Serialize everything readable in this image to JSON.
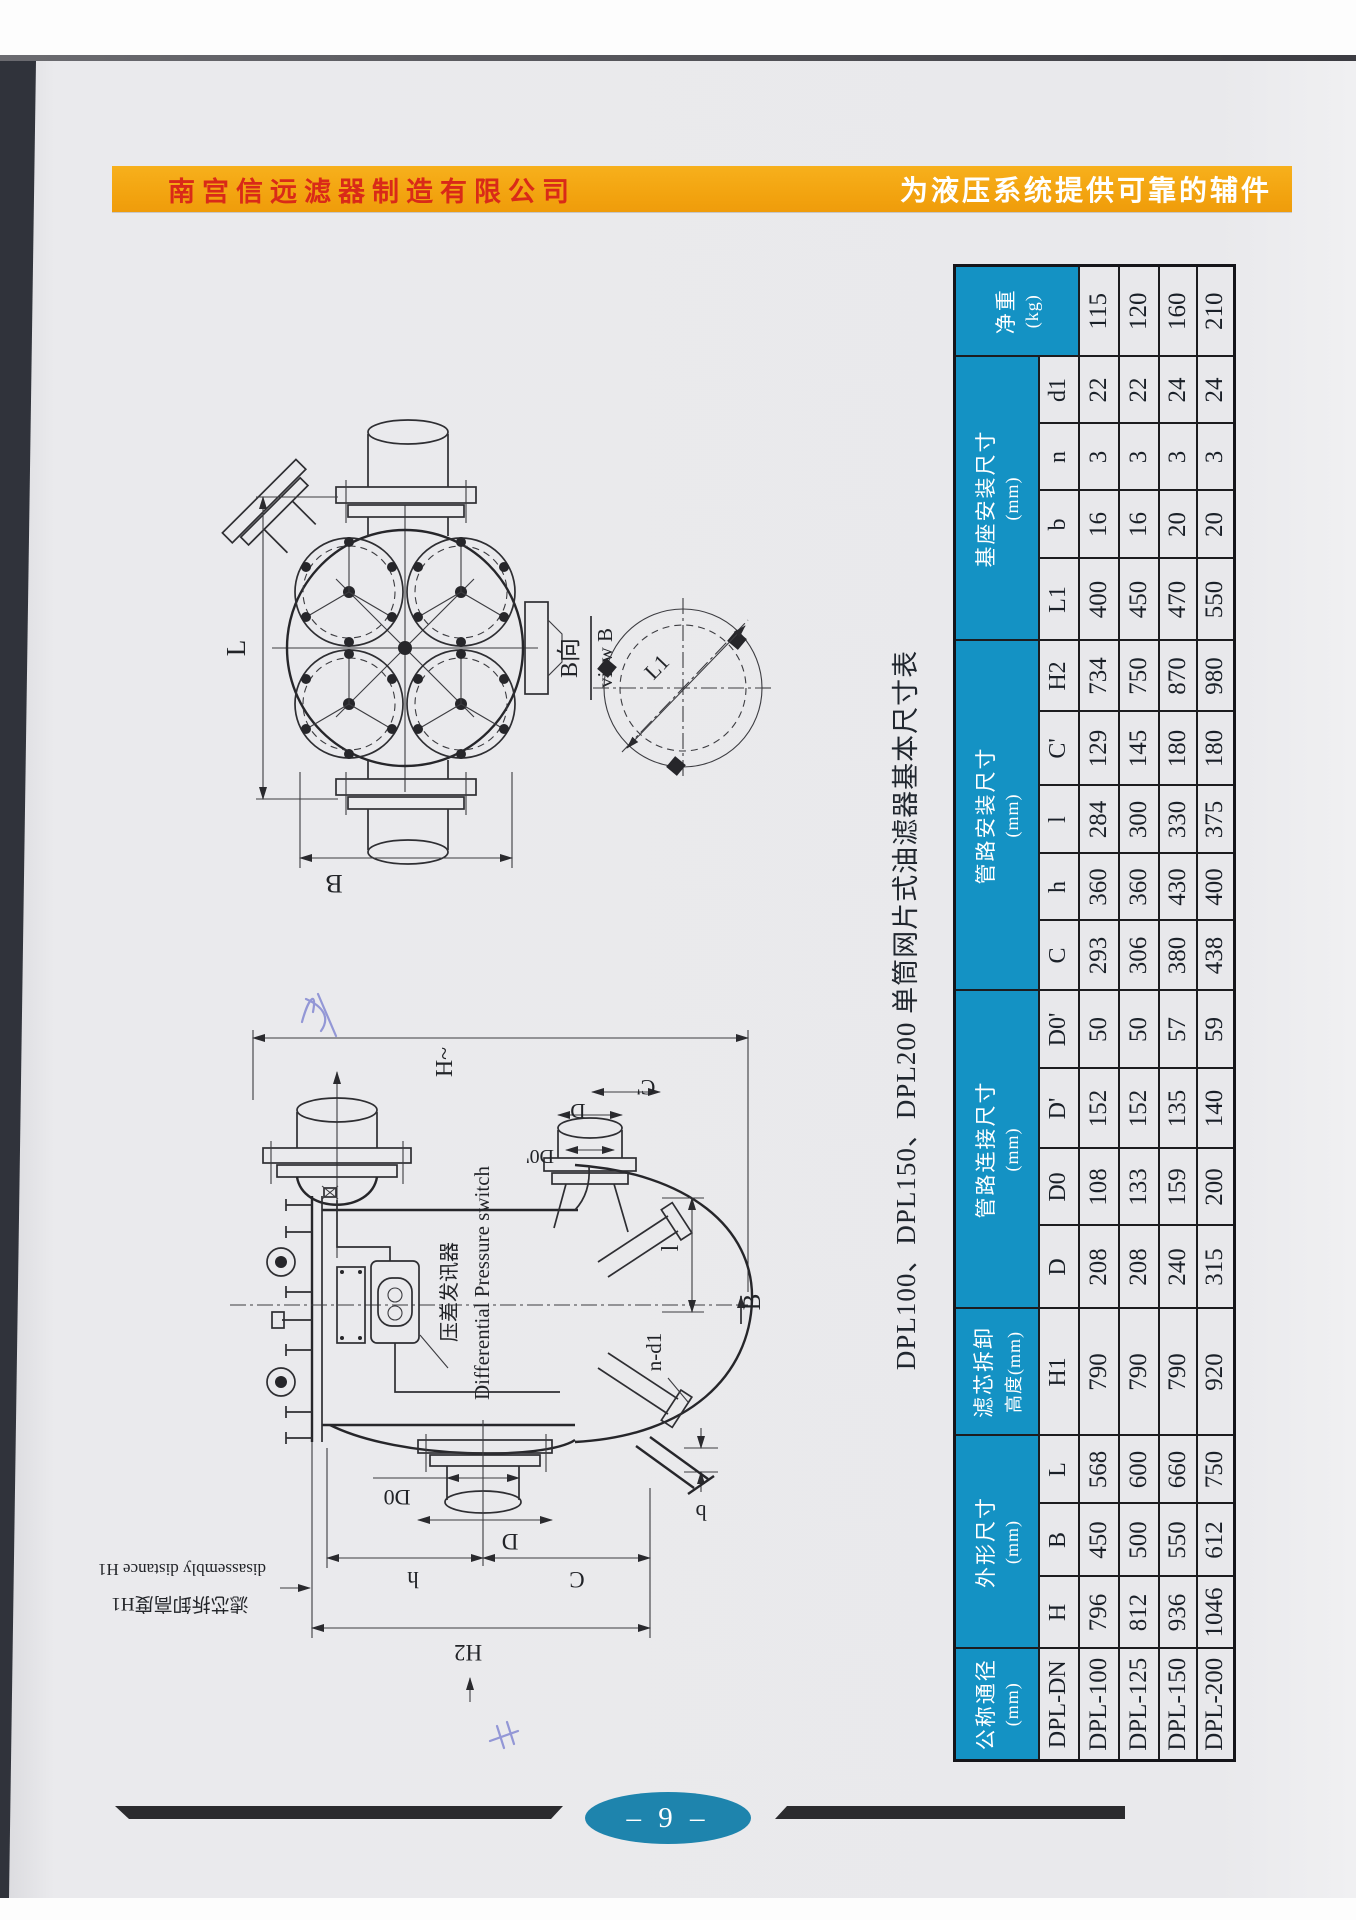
{
  "banner": {
    "company": "南宫信远滤器制造有限公司",
    "slogan": "为液压系统提供可靠的辅件"
  },
  "table": {
    "title": "DPL100、DPL150、DPL200 单筒网片式油滤器基本尺寸表",
    "groups": [
      {
        "label": "公称通径",
        "unit": "(mm)",
        "subs": [
          "DPL-DN"
        ]
      },
      {
        "label": "外形尺寸",
        "unit": "(mm)",
        "subs": [
          "H",
          "B",
          "L"
        ]
      },
      {
        "label": "滤芯拆卸",
        "unit": "高度(mm)",
        "subs": [
          "H1"
        ]
      },
      {
        "label": "管路连接尺寸",
        "unit": "(mm)",
        "subs": [
          "D",
          "D0",
          "D'",
          "D0'"
        ]
      },
      {
        "label": "管路安装尺寸",
        "unit": "(mm)",
        "subs": [
          "C",
          "h",
          "l",
          "C'",
          "H2"
        ]
      },
      {
        "label": "基座安装尺寸",
        "unit": "(mm)",
        "subs": [
          "L1",
          "b",
          "n",
          "d1"
        ]
      },
      {
        "label": "净重",
        "unit": "(kg)",
        "subs": []
      }
    ],
    "rows": [
      {
        "model": "DPL-100",
        "values": [
          "796",
          "450",
          "568",
          "790",
          "208",
          "108",
          "152",
          "50",
          "293",
          "360",
          "284",
          "129",
          "734",
          "400",
          "16",
          "3",
          "22",
          "115"
        ]
      },
      {
        "model": "DPL-125",
        "values": [
          "812",
          "500",
          "600",
          "790",
          "208",
          "133",
          "152",
          "50",
          "306",
          "360",
          "300",
          "145",
          "750",
          "450",
          "16",
          "3",
          "22",
          "120"
        ]
      },
      {
        "model": "DPL-150",
        "values": [
          "936",
          "550",
          "660",
          "790",
          "240",
          "159",
          "135",
          "57",
          "380",
          "430",
          "330",
          "180",
          "870",
          "470",
          "20",
          "3",
          "24",
          "160"
        ]
      },
      {
        "model": "DPL-200",
        "values": [
          "1046",
          "612",
          "750",
          "920",
          "315",
          "200",
          "140",
          "59",
          "438",
          "400",
          "375",
          "180",
          "980",
          "550",
          "20",
          "3",
          "24",
          "210"
        ]
      }
    ]
  },
  "drawings": {
    "top_view": {
      "dim_L": "L",
      "dim_B": "B",
      "view_cn": "B向",
      "view_en": "view B",
      "detail_dim": "L1"
    },
    "side_view": {
      "dim_H": "H~",
      "dim_C_prime": "C'",
      "dim_D_prime": "D'",
      "dim_D0_prime": "D0'",
      "dp_switch_cn": "压差发讯器",
      "dp_switch_en": "Differential Pressure switch",
      "dim_l": "l",
      "view_B": "B",
      "bolt_note": "n-d1",
      "dim_b": "b",
      "dim_D0": "D0",
      "dim_D": "D",
      "dim_h": "h",
      "dim_C": "C",
      "dim_H2": "H2",
      "removal_cn": "滤芯拆卸高度H1",
      "removal_en": "disassembly distance H1"
    }
  },
  "footer": {
    "page_number": "– 9 –"
  },
  "colors": {
    "banner_orange": "#F2A20E",
    "banner_text_red": "#D92A18",
    "header_blue": "#1492C4",
    "footer_teal": "#1E84AD",
    "paper": "#E9E9EC"
  }
}
